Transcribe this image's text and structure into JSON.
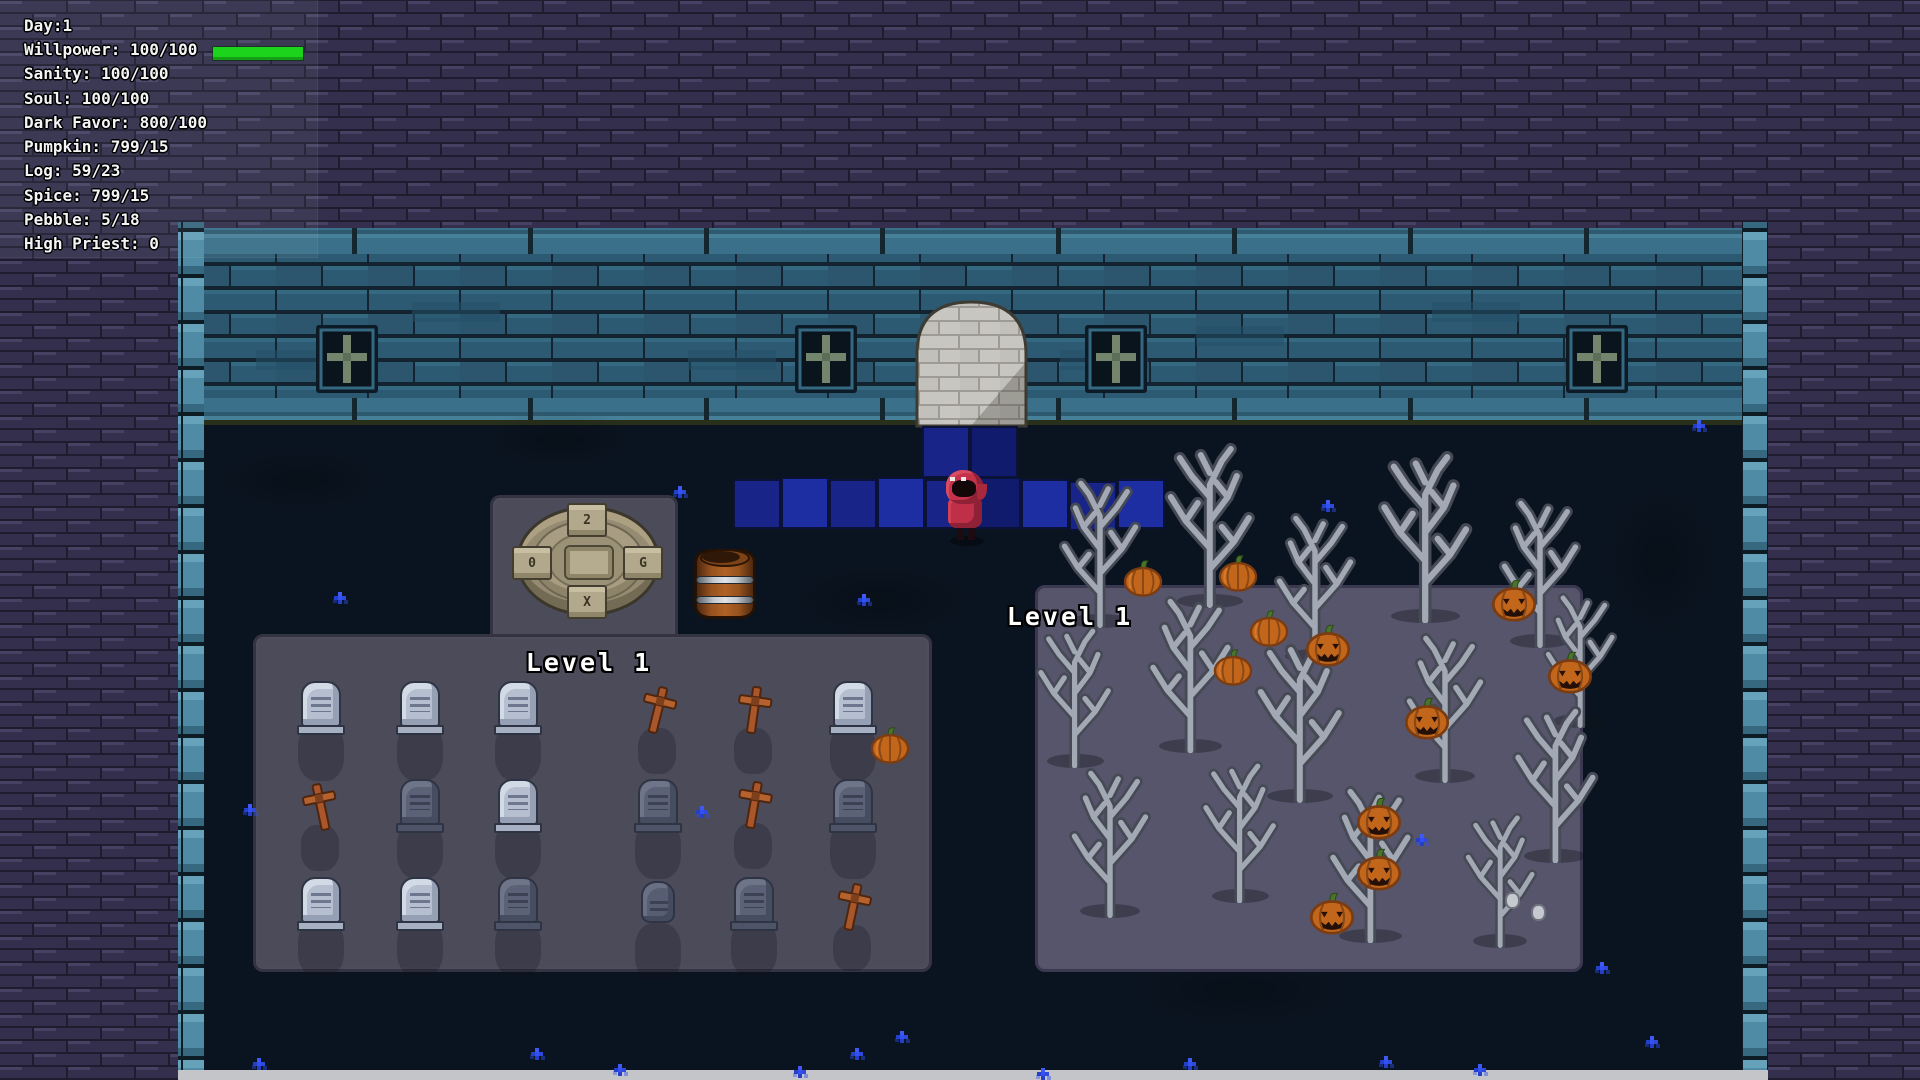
{
  "hud": {
    "lines": [
      {
        "text": "Day:1"
      },
      {
        "text": "Willpower: 100/100",
        "bar": true
      },
      {
        "text": "Sanity: 100/100"
      },
      {
        "text": "Soul: 100/100"
      },
      {
        "text": "Dark Favor: 800/100"
      },
      {
        "text": "Pumpkin: 799/15"
      },
      {
        "text": "Log: 59/23"
      },
      {
        "text": "Spice: 799/15"
      },
      {
        "text": "Pebble: 5/18"
      },
      {
        "text": "High Priest: 0"
      }
    ],
    "willpower_bar": {
      "color": "#1bd41b",
      "fill_ratio": 1.0
    }
  },
  "labels": {
    "graveyard_level": "Level 1",
    "pumpkin_patch_level": "Level 1"
  },
  "altar": {
    "runes": [
      "2",
      "0",
      "G",
      "X"
    ]
  },
  "colors": {
    "outer_brick": "#332f4c",
    "wall_teal": "#2d5a73",
    "ground": "#0a1420",
    "graveyard_plot": "#4b4b59",
    "patch_plot": "#57556b",
    "path_shades": {
      "s1": "#1d2da2",
      "s2": "#182487",
      "s3": "#111b6e"
    },
    "pumpkin_orange": "#c2661c",
    "cross_wood": "#b5622e",
    "character_red": "#c4334b",
    "bar_green": "#1bd41b",
    "flower_blue": "#3350f2"
  },
  "world": {
    "tombstones": [
      {
        "x": 321,
        "y": 707,
        "v": "light"
      },
      {
        "x": 420,
        "y": 707,
        "v": "light"
      },
      {
        "x": 518,
        "y": 707,
        "v": "light"
      },
      {
        "x": 853,
        "y": 707,
        "v": "light"
      },
      {
        "x": 420,
        "y": 805,
        "v": "dark"
      },
      {
        "x": 518,
        "y": 805,
        "v": "light"
      },
      {
        "x": 658,
        "y": 805,
        "v": "dark"
      },
      {
        "x": 853,
        "y": 805,
        "v": "dark"
      },
      {
        "x": 321,
        "y": 903,
        "v": "light"
      },
      {
        "x": 420,
        "y": 903,
        "v": "light"
      },
      {
        "x": 518,
        "y": 903,
        "v": "dark"
      },
      {
        "x": 658,
        "y": 907,
        "v": "small"
      },
      {
        "x": 754,
        "y": 903,
        "v": "dark"
      }
    ],
    "crosses": [
      {
        "x": 658,
        "y": 710,
        "r": 14
      },
      {
        "x": 754,
        "y": 710,
        "r": 8
      },
      {
        "x": 321,
        "y": 807,
        "r": -12
      },
      {
        "x": 754,
        "y": 805,
        "r": 10
      },
      {
        "x": 853,
        "y": 907,
        "r": 12
      }
    ],
    "trees": [
      {
        "x": 1100,
        "y": 620,
        "s": 1.0,
        "f": 1
      },
      {
        "x": 1210,
        "y": 600,
        "s": 1.1,
        "f": -1
      },
      {
        "x": 1315,
        "y": 655,
        "s": 1.0,
        "f": 1
      },
      {
        "x": 1425,
        "y": 615,
        "s": 1.15,
        "f": -1
      },
      {
        "x": 1540,
        "y": 640,
        "s": 1.0,
        "f": 1
      },
      {
        "x": 1580,
        "y": 720,
        "s": 0.9,
        "f": 1
      },
      {
        "x": 1075,
        "y": 760,
        "s": 0.95,
        "f": -1
      },
      {
        "x": 1190,
        "y": 745,
        "s": 1.05,
        "f": 1
      },
      {
        "x": 1300,
        "y": 795,
        "s": 1.1,
        "f": -1
      },
      {
        "x": 1445,
        "y": 775,
        "s": 1.0,
        "f": 1
      },
      {
        "x": 1555,
        "y": 855,
        "s": 1.05,
        "f": -1
      },
      {
        "x": 1110,
        "y": 910,
        "s": 1.0,
        "f": 1
      },
      {
        "x": 1240,
        "y": 895,
        "s": 0.95,
        "f": -1
      },
      {
        "x": 1370,
        "y": 935,
        "s": 1.05,
        "f": 1
      },
      {
        "x": 1500,
        "y": 940,
        "s": 0.9,
        "f": -1
      }
    ],
    "pumpkins": [
      {
        "x": 1143,
        "y": 578,
        "j": 0
      },
      {
        "x": 1238,
        "y": 573,
        "j": 0
      },
      {
        "x": 1269,
        "y": 628,
        "j": 0
      },
      {
        "x": 1233,
        "y": 667,
        "j": 0
      },
      {
        "x": 1328,
        "y": 645,
        "j": 1
      },
      {
        "x": 1514,
        "y": 600,
        "j": 1
      },
      {
        "x": 1570,
        "y": 672,
        "j": 1
      },
      {
        "x": 1427,
        "y": 718,
        "j": 1
      },
      {
        "x": 1379,
        "y": 818,
        "j": 1
      },
      {
        "x": 1379,
        "y": 869,
        "j": 1
      },
      {
        "x": 1332,
        "y": 913,
        "j": 1
      },
      {
        "x": 890,
        "y": 745,
        "j": 0
      }
    ],
    "path_tiles": [
      {
        "x": 922,
        "y": 426,
        "w": 48,
        "h": 52,
        "c": "s2"
      },
      {
        "x": 970,
        "y": 426,
        "w": 48,
        "h": 52,
        "c": "s3"
      },
      {
        "x": 733,
        "y": 479,
        "w": 48,
        "h": 50,
        "c": "s2"
      },
      {
        "x": 781,
        "y": 477,
        "w": 48,
        "h": 52,
        "c": "s1"
      },
      {
        "x": 829,
        "y": 479,
        "w": 48,
        "h": 50,
        "c": "s2"
      },
      {
        "x": 877,
        "y": 477,
        "w": 48,
        "h": 52,
        "c": "s1"
      },
      {
        "x": 925,
        "y": 479,
        "w": 48,
        "h": 50,
        "c": "s2"
      },
      {
        "x": 973,
        "y": 477,
        "w": 48,
        "h": 52,
        "c": "s3"
      },
      {
        "x": 1021,
        "y": 479,
        "w": 48,
        "h": 50,
        "c": "s1"
      },
      {
        "x": 1069,
        "y": 481,
        "w": 48,
        "h": 50,
        "c": "s2"
      },
      {
        "x": 1117,
        "y": 479,
        "w": 48,
        "h": 50,
        "c": "s1"
      }
    ],
    "flowers": [
      {
        "x": 257,
        "y": 1062
      },
      {
        "x": 535,
        "y": 1052
      },
      {
        "x": 618,
        "y": 1068
      },
      {
        "x": 798,
        "y": 1070
      },
      {
        "x": 855,
        "y": 1052
      },
      {
        "x": 1041,
        "y": 1072
      },
      {
        "x": 1188,
        "y": 1062
      },
      {
        "x": 1384,
        "y": 1060
      },
      {
        "x": 1478,
        "y": 1068
      },
      {
        "x": 1600,
        "y": 966
      },
      {
        "x": 1697,
        "y": 424
      },
      {
        "x": 1326,
        "y": 504
      },
      {
        "x": 862,
        "y": 598
      },
      {
        "x": 678,
        "y": 490
      },
      {
        "x": 338,
        "y": 596
      },
      {
        "x": 1420,
        "y": 838
      },
      {
        "x": 700,
        "y": 810
      },
      {
        "x": 248,
        "y": 808
      },
      {
        "x": 1650,
        "y": 1040
      },
      {
        "x": 900,
        "y": 1035
      }
    ],
    "stones": [
      {
        "x": 1512,
        "y": 900
      },
      {
        "x": 1538,
        "y": 912
      }
    ],
    "mottles": [
      {
        "x": 560,
        "y": 440,
        "w": 160,
        "h": 60
      },
      {
        "x": 880,
        "y": 600,
        "w": 200,
        "h": 80
      },
      {
        "x": 1240,
        "y": 990,
        "w": 240,
        "h": 80
      },
      {
        "x": 460,
        "y": 940,
        "w": 200,
        "h": 70
      },
      {
        "x": 1660,
        "y": 560,
        "w": 120,
        "h": 160
      },
      {
        "x": 300,
        "y": 480,
        "w": 180,
        "h": 70
      }
    ]
  }
}
